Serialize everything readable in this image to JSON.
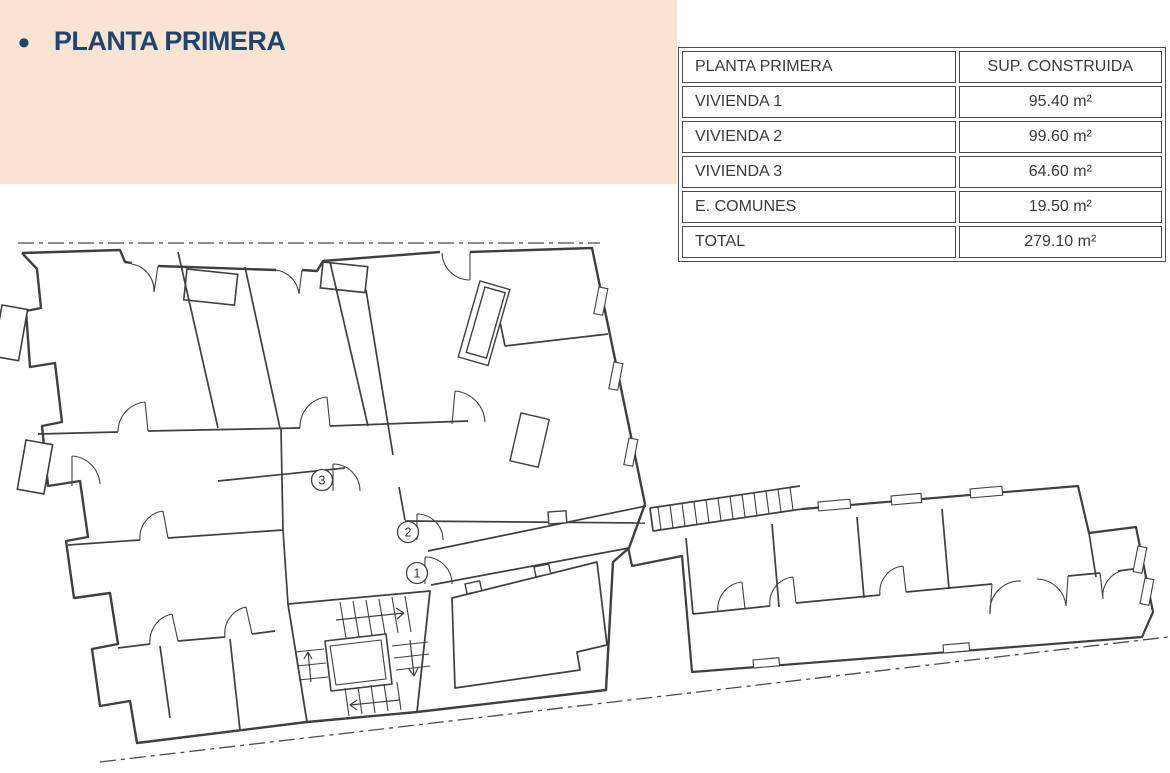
{
  "header": {
    "bullet": "•",
    "title": "PLANTA PRIMERA",
    "banner_color": "#f9e3d1",
    "title_color": "#1e4571"
  },
  "table": {
    "header": {
      "col1": "PLANTA PRIMERA",
      "col2": "SUP. CONSTRUIDA"
    },
    "rows": [
      {
        "label": "VIVIENDA 1",
        "value": "95.40 m²"
      },
      {
        "label": "VIVIENDA 2",
        "value": "99.60 m²"
      },
      {
        "label": "VIVIENDA 3",
        "value": "64.60 m²"
      },
      {
        "label": "E. COMUNES",
        "value": "19.50 m²"
      },
      {
        "label": "TOTAL",
        "value": "279.10 m²"
      }
    ]
  },
  "floorplan": {
    "door_labels": [
      "3",
      "2",
      "1"
    ],
    "line_color": "#3f3f3f",
    "boundary_color": "#4a4a4a"
  }
}
